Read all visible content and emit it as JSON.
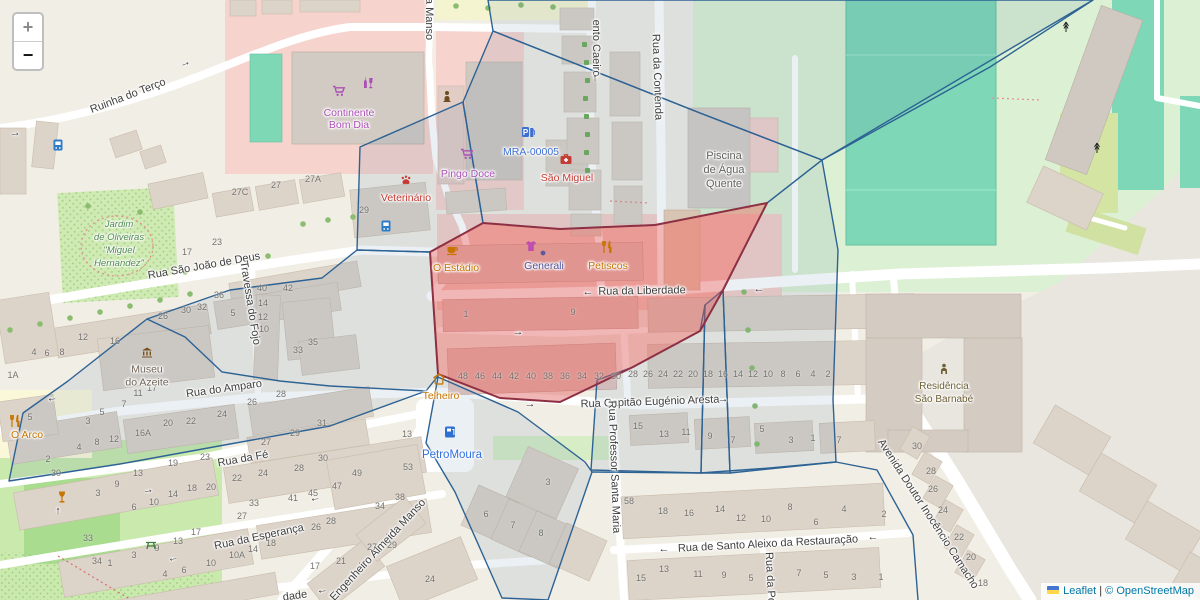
{
  "map_ui": {
    "zoom_in_label": "+",
    "zoom_out_label": "−",
    "attribution": {
      "leaflet_link": "Leaflet",
      "separator": " | ",
      "copyright_text": "© OpenStreetMap"
    }
  },
  "colors": {
    "boundary_blue": "#2d6294",
    "highlight_red_fill": "rgba(222,80,80,0.42)",
    "highlight_red_stroke": "#8e3044",
    "shop_purple": "#ab4fb5",
    "poi_orange": "#c77400",
    "poi_red": "#c43c35",
    "poi_blue": "#3f6fd1",
    "park_green_label": "#4f8a4f"
  },
  "street_labels": [
    {
      "text": "Ruinha do Terço",
      "x": 128,
      "y": 96,
      "rot": -21
    },
    {
      "text": "a Manso",
      "x": 429,
      "y": 19,
      "rot": 90
    },
    {
      "text": "ento Caeiro",
      "x": 596,
      "y": 48,
      "rot": 90
    },
    {
      "text": "Rua da Contenda",
      "x": 657,
      "y": 77,
      "rot": 88
    },
    {
      "text": "Rua São João de Deus",
      "x": 204,
      "y": 266,
      "rot": -10
    },
    {
      "text": "Travessa do Fojo",
      "x": 250,
      "y": 303,
      "rot": 81
    },
    {
      "text": "Rua do Amparo",
      "x": 224,
      "y": 389,
      "rot": -8
    },
    {
      "text": "Rua da Fé",
      "x": 243,
      "y": 459,
      "rot": -10
    },
    {
      "text": "Rua da Esperança",
      "x": 259,
      "y": 537,
      "rot": -12
    },
    {
      "text": "Rua da Liberdade",
      "x": 642,
      "y": 291,
      "rot": -1
    },
    {
      "text": "Rua Capitão Eugénio Aresta",
      "x": 650,
      "y": 402,
      "rot": -2
    },
    {
      "text": "Rua de Santo Aleixo da Restauração",
      "x": 768,
      "y": 544,
      "rot": -3
    },
    {
      "text": "Rua Professor Santa Maria",
      "x": 614,
      "y": 467,
      "rot": 88
    },
    {
      "text": "Avenida Doutor Inocêncio Camacho",
      "x": 928,
      "y": 514,
      "rot": 57
    },
    {
      "text": "Engenheiro Almeida Manso",
      "x": 378,
      "y": 550,
      "rot": -47
    },
    {
      "text": "dade",
      "x": 295,
      "y": 596,
      "rot": -8
    },
    {
      "text": "Rua da Pó",
      "x": 770,
      "y": 578,
      "rot": 87
    }
  ],
  "poi_labels": [
    {
      "name": "continente-bom-dia",
      "lines": [
        "Continente",
        "Bom Dia"
      ],
      "x": 349,
      "y": 119,
      "lh": 12,
      "color": "#ab4fb5",
      "icons": [
        {
          "k": "cart",
          "n": "shopping-cart-icon",
          "x": 339,
          "y": 91,
          "c": "#ab4fb5"
        },
        {
          "k": "alcohol",
          "n": "alcohol-shop-icon",
          "x": 368,
          "y": 83,
          "c": "#ab4fb5"
        }
      ]
    },
    {
      "name": "pingo-doce",
      "lines": [
        "Pingo Doce"
      ],
      "x": 468,
      "y": 174,
      "lh": 12,
      "color": "#ab4fb5",
      "icons": [
        {
          "k": "cart",
          "n": "shopping-cart-icon",
          "x": 467,
          "y": 154,
          "c": "#ab4fb5"
        }
      ]
    },
    {
      "name": "mra-00005",
      "lines": [
        "MRA-00005"
      ],
      "x": 531,
      "y": 152,
      "lh": 12,
      "color": "#3f6fd1",
      "icons": [
        {
          "k": "parkfuel",
          "n": "parking-fuel-icon",
          "x": 528,
          "y": 132,
          "c": "#3e6fd0"
        }
      ]
    },
    {
      "name": "sao-miguel",
      "lines": [
        "São Miguel"
      ],
      "x": 567,
      "y": 178,
      "lh": 12,
      "color": "#c43c35",
      "icons": [
        {
          "k": "medkit",
          "n": "pharmacy-medkit-icon",
          "x": 566,
          "y": 159,
          "c": "#c43c35"
        }
      ]
    },
    {
      "name": "veterinario",
      "lines": [
        "Veterinário"
      ],
      "x": 406,
      "y": 198,
      "lh": 12,
      "color": "#c43c35",
      "icons": [
        {
          "k": "paw",
          "n": "paw-icon",
          "x": 406,
          "y": 180,
          "c": "#c43c35"
        }
      ]
    },
    {
      "name": "bust-statue",
      "lines": [],
      "x": 447,
      "y": 96,
      "lh": 12,
      "color": "#6d4c1e",
      "icons": [
        {
          "k": "bust",
          "n": "bust-statue-icon",
          "x": 447,
          "y": 96,
          "c": "#6d4c1e"
        }
      ]
    },
    {
      "name": "o-estadio",
      "lines": [
        "O Estádio"
      ],
      "x": 456,
      "y": 268,
      "lh": 12,
      "color": "#c77400",
      "icons": [
        {
          "k": "cup",
          "n": "cafe-cup-icon",
          "x": 452,
          "y": 250,
          "c": "#c77400"
        }
      ]
    },
    {
      "name": "generali",
      "lines": [
        "Generali"
      ],
      "x": 544,
      "y": 266,
      "lh": 12,
      "color": "#50549b",
      "icons": [
        {
          "k": "dot",
          "n": "office-dot-icon",
          "x": 543,
          "y": 253,
          "c": "#5b5a9e"
        },
        {
          "k": "clothes",
          "n": "clothing-shop-icon",
          "x": 531,
          "y": 246,
          "c": "#bf4fae"
        }
      ]
    },
    {
      "name": "petiscos",
      "lines": [
        "Petiscos"
      ],
      "x": 608,
      "y": 266,
      "lh": 12,
      "color": "#c77400",
      "icons": [
        {
          "k": "forkknife",
          "n": "restaurant-icon",
          "x": 607,
          "y": 247,
          "c": "#c77400"
        }
      ]
    },
    {
      "name": "telheiro",
      "lines": [
        "Telheiro"
      ],
      "x": 441,
      "y": 396,
      "lh": 12,
      "color": "#c77400",
      "icons": [
        {
          "k": "shelter",
          "n": "shelter-icon",
          "x": 439,
          "y": 379,
          "c": "#c77400"
        }
      ]
    },
    {
      "name": "petromoura",
      "lines": [
        "PetroMoura"
      ],
      "x": 452,
      "y": 455,
      "lh": 12,
      "fs": 11.5,
      "color": "#2f6fe0",
      "icons": [
        {
          "k": "fuel",
          "n": "fuel-station-icon",
          "x": 450,
          "y": 432,
          "c": "#2f6fd0"
        }
      ]
    },
    {
      "name": "museu-do-azeite",
      "lines": [
        "Museu",
        "do Azeite"
      ],
      "x": 147,
      "y": 376,
      "lh": 12.5,
      "color": "#6f6456",
      "icons": [
        {
          "k": "museum",
          "n": "museum-icon",
          "x": 147,
          "y": 352,
          "c": "#77501f"
        }
      ]
    },
    {
      "name": "piscina-de-agua-quente",
      "lines": [
        "Piscina",
        "de Água",
        "Quente"
      ],
      "x": 724,
      "y": 170,
      "lh": 14,
      "fs": 11,
      "color": "#63635c",
      "icons": []
    },
    {
      "name": "residencia-sao-barnabe",
      "lines": [
        "Residência",
        "São Barnabé"
      ],
      "x": 944,
      "y": 393,
      "lh": 13,
      "fs": 10,
      "color": "#6d5f33",
      "icons": [
        {
          "k": "person",
          "n": "residence-person-icon",
          "x": 944,
          "y": 369,
          "c": "#6d5f33"
        }
      ]
    },
    {
      "name": "jardim-de-oliveiras",
      "lines": [
        "Jardim",
        "de Oliveiras",
        "\"Miguel",
        "Hernandez\""
      ],
      "x": 119,
      "y": 244,
      "lh": 13,
      "fs": 9.5,
      "italic": true,
      "color": "#4f8a4f",
      "icons": []
    },
    {
      "name": "o-arco",
      "lines": [
        "O Arco"
      ],
      "x": 27,
      "y": 435,
      "lh": 12,
      "color": "#c77400",
      "icons": [
        {
          "k": "forkknife",
          "n": "restaurant-icon",
          "x": 15,
          "y": 421,
          "c": "#c77400"
        }
      ]
    },
    {
      "name": "bar-wineglass",
      "lines": [],
      "x": 62,
      "y": 497,
      "lh": 12,
      "color": "#c77400",
      "icons": [
        {
          "k": "wine",
          "n": "wine-bar-icon",
          "x": 62,
          "y": 497,
          "c": "#c77400"
        }
      ]
    },
    {
      "name": "picnic-site",
      "lines": [],
      "x": 151,
      "y": 545,
      "lh": 12,
      "color": "#3f7d3f",
      "icons": [
        {
          "k": "picnic",
          "n": "picnic-table-icon",
          "x": 151,
          "y": 545,
          "c": "#3f7d3f"
        }
      ]
    },
    {
      "name": "antenna-1",
      "lines": [],
      "x": 1066,
      "y": 27,
      "lh": 12,
      "color": "#333",
      "icons": [
        {
          "k": "antenna",
          "n": "antenna-mast-icon",
          "x": 1066,
          "y": 27,
          "c": "#222"
        }
      ]
    },
    {
      "name": "antenna-2",
      "lines": [],
      "x": 1097,
      "y": 148,
      "lh": 12,
      "color": "#333",
      "icons": [
        {
          "k": "antenna",
          "n": "antenna-mast-icon",
          "x": 1097,
          "y": 148,
          "c": "#222"
        }
      ]
    },
    {
      "name": "bus-stop-1",
      "lines": [],
      "x": 58,
      "y": 145,
      "lh": 12,
      "color": "#2e7cc7",
      "icons": [
        {
          "k": "bus",
          "n": "bus-stop-icon",
          "x": 58,
          "y": 145,
          "c": "#2e7cc7"
        }
      ]
    },
    {
      "name": "bus-stop-2",
      "lines": [],
      "x": 386,
      "y": 226,
      "lh": 12,
      "color": "#2e7cc7",
      "icons": [
        {
          "k": "bus",
          "n": "bus-stop-icon",
          "x": 386,
          "y": 226,
          "c": "#2e7cc7"
        }
      ]
    }
  ],
  "oneway_arrows": [
    [
      185,
      63,
      -21,
      "→"
    ],
    [
      15,
      133,
      -5,
      "→"
    ],
    [
      588,
      292,
      0,
      "←"
    ],
    [
      759,
      289,
      0,
      "←"
    ],
    [
      530,
      404,
      0,
      "→"
    ],
    [
      723,
      399,
      0,
      "→"
    ],
    [
      664,
      549,
      0,
      "←"
    ],
    [
      873,
      537,
      0,
      "←"
    ],
    [
      148,
      490,
      -9,
      "→"
    ],
    [
      315,
      498,
      -9,
      "←"
    ],
    [
      173,
      558,
      -11,
      "←"
    ],
    [
      322,
      590,
      -8,
      "←"
    ],
    [
      518,
      332,
      0,
      "→"
    ],
    [
      595,
      78,
      0,
      "↑"
    ],
    [
      58,
      511,
      0,
      "↑"
    ],
    [
      52,
      398,
      -8,
      "←"
    ]
  ],
  "house_numbers": [
    [
      463,
      376,
      "48"
    ],
    [
      480,
      376,
      "46"
    ],
    [
      497,
      376,
      "44"
    ],
    [
      514,
      376,
      "42"
    ],
    [
      531,
      376,
      "40"
    ],
    [
      548,
      376,
      "38"
    ],
    [
      565,
      376,
      "36"
    ],
    [
      582,
      376,
      "34"
    ],
    [
      599,
      376,
      "32"
    ],
    [
      616,
      376,
      "30"
    ],
    [
      633,
      374,
      "28"
    ],
    [
      648,
      374,
      "26"
    ],
    [
      663,
      374,
      "24"
    ],
    [
      678,
      374,
      "22"
    ],
    [
      693,
      374,
      "20"
    ],
    [
      708,
      374,
      "18"
    ],
    [
      723,
      374,
      "16"
    ],
    [
      738,
      374,
      "14"
    ],
    [
      753,
      374,
      "12"
    ],
    [
      768,
      374,
      "10"
    ],
    [
      783,
      374,
      "8"
    ],
    [
      798,
      374,
      "6"
    ],
    [
      813,
      374,
      "4"
    ],
    [
      828,
      374,
      "2"
    ],
    [
      466,
      314,
      "1"
    ],
    [
      573,
      312,
      "9"
    ],
    [
      638,
      426,
      "15"
    ],
    [
      664,
      434,
      "13"
    ],
    [
      686,
      432,
      "11"
    ],
    [
      710,
      436,
      "9"
    ],
    [
      733,
      440,
      "7"
    ],
    [
      762,
      429,
      "5"
    ],
    [
      791,
      440,
      "3"
    ],
    [
      813,
      438,
      "1"
    ],
    [
      839,
      440,
      "7"
    ],
    [
      629,
      501,
      "58"
    ],
    [
      663,
      511,
      "18"
    ],
    [
      689,
      513,
      "16"
    ],
    [
      720,
      509,
      "14"
    ],
    [
      741,
      518,
      "12"
    ],
    [
      766,
      519,
      "10"
    ],
    [
      790,
      507,
      "8"
    ],
    [
      816,
      522,
      "6"
    ],
    [
      844,
      509,
      "4"
    ],
    [
      884,
      514,
      "2"
    ],
    [
      641,
      578,
      "15"
    ],
    [
      664,
      569,
      "13"
    ],
    [
      698,
      574,
      "11"
    ],
    [
      724,
      575,
      "9"
    ],
    [
      751,
      578,
      "5"
    ],
    [
      799,
      573,
      "7"
    ],
    [
      826,
      575,
      "5"
    ],
    [
      854,
      577,
      "3"
    ],
    [
      881,
      577,
      "1"
    ],
    [
      917,
      446,
      "30"
    ],
    [
      931,
      471,
      "28"
    ],
    [
      933,
      489,
      "26"
    ],
    [
      943,
      510,
      "24"
    ],
    [
      959,
      537,
      "22"
    ],
    [
      971,
      557,
      "20"
    ],
    [
      983,
      583,
      "18"
    ],
    [
      240,
      192,
      "27C"
    ],
    [
      276,
      185,
      "27"
    ],
    [
      313,
      179,
      "27A"
    ],
    [
      364,
      210,
      "29"
    ],
    [
      217,
      242,
      "23"
    ],
    [
      187,
      252,
      "17"
    ],
    [
      163,
      316,
      "26"
    ],
    [
      186,
      310,
      "30"
    ],
    [
      202,
      307,
      "32"
    ],
    [
      219,
      295,
      "36"
    ],
    [
      262,
      288,
      "40"
    ],
    [
      288,
      288,
      "42"
    ],
    [
      263,
      303,
      "14"
    ],
    [
      263,
      317,
      "12"
    ],
    [
      264,
      329,
      "10"
    ],
    [
      233,
      313,
      "5"
    ],
    [
      313,
      342,
      "35"
    ],
    [
      298,
      350,
      "33"
    ],
    [
      83,
      337,
      "12"
    ],
    [
      115,
      341,
      "16"
    ],
    [
      34,
      352,
      "4"
    ],
    [
      47,
      353,
      "6"
    ],
    [
      62,
      352,
      "8"
    ],
    [
      13,
      375,
      "1A"
    ],
    [
      152,
      388,
      "17"
    ],
    [
      138,
      393,
      "11"
    ],
    [
      124,
      404,
      "7"
    ],
    [
      102,
      412,
      "5"
    ],
    [
      88,
      421,
      "3"
    ],
    [
      30,
      417,
      "5"
    ],
    [
      143,
      433,
      "16A"
    ],
    [
      168,
      423,
      "20"
    ],
    [
      191,
      421,
      "22"
    ],
    [
      222,
      414,
      "24"
    ],
    [
      252,
      402,
      "26"
    ],
    [
      281,
      394,
      "28"
    ],
    [
      322,
      423,
      "31"
    ],
    [
      295,
      433,
      "29"
    ],
    [
      266,
      442,
      "27"
    ],
    [
      97,
      442,
      "8"
    ],
    [
      114,
      439,
      "12"
    ],
    [
      79,
      447,
      "4"
    ],
    [
      48,
      459,
      "2"
    ],
    [
      56,
      473,
      "30"
    ],
    [
      205,
      457,
      "23"
    ],
    [
      173,
      463,
      "19"
    ],
    [
      138,
      473,
      "13"
    ],
    [
      117,
      484,
      "9"
    ],
    [
      98,
      493,
      "3"
    ],
    [
      192,
      488,
      "18"
    ],
    [
      173,
      494,
      "14"
    ],
    [
      154,
      502,
      "10"
    ],
    [
      134,
      507,
      "6"
    ],
    [
      237,
      478,
      "22"
    ],
    [
      211,
      487,
      "20"
    ],
    [
      263,
      473,
      "24"
    ],
    [
      299,
      468,
      "28"
    ],
    [
      323,
      458,
      "30"
    ],
    [
      293,
      498,
      "41"
    ],
    [
      313,
      493,
      "45"
    ],
    [
      254,
      503,
      "33"
    ],
    [
      242,
      516,
      "27"
    ],
    [
      196,
      532,
      "17"
    ],
    [
      178,
      541,
      "13"
    ],
    [
      157,
      548,
      "9"
    ],
    [
      134,
      555,
      "3"
    ],
    [
      88,
      538,
      "33"
    ],
    [
      97,
      561,
      "34"
    ],
    [
      110,
      563,
      "1"
    ],
    [
      316,
      527,
      "26"
    ],
    [
      271,
      543,
      "18"
    ],
    [
      253,
      549,
      "14"
    ],
    [
      237,
      555,
      "10A"
    ],
    [
      211,
      563,
      "10"
    ],
    [
      184,
      570,
      "6"
    ],
    [
      165,
      574,
      "4"
    ],
    [
      407,
      434,
      "13"
    ],
    [
      408,
      467,
      "53"
    ],
    [
      357,
      473,
      "49"
    ],
    [
      337,
      486,
      "47"
    ],
    [
      400,
      497,
      "38"
    ],
    [
      380,
      506,
      "34"
    ],
    [
      331,
      521,
      "28"
    ],
    [
      372,
      547,
      "27"
    ],
    [
      392,
      545,
      "29"
    ],
    [
      315,
      566,
      "17"
    ],
    [
      341,
      561,
      "21"
    ],
    [
      430,
      579,
      "24"
    ],
    [
      548,
      482,
      "3"
    ],
    [
      486,
      514,
      "6"
    ],
    [
      513,
      525,
      "7"
    ],
    [
      541,
      533,
      "8"
    ]
  ]
}
